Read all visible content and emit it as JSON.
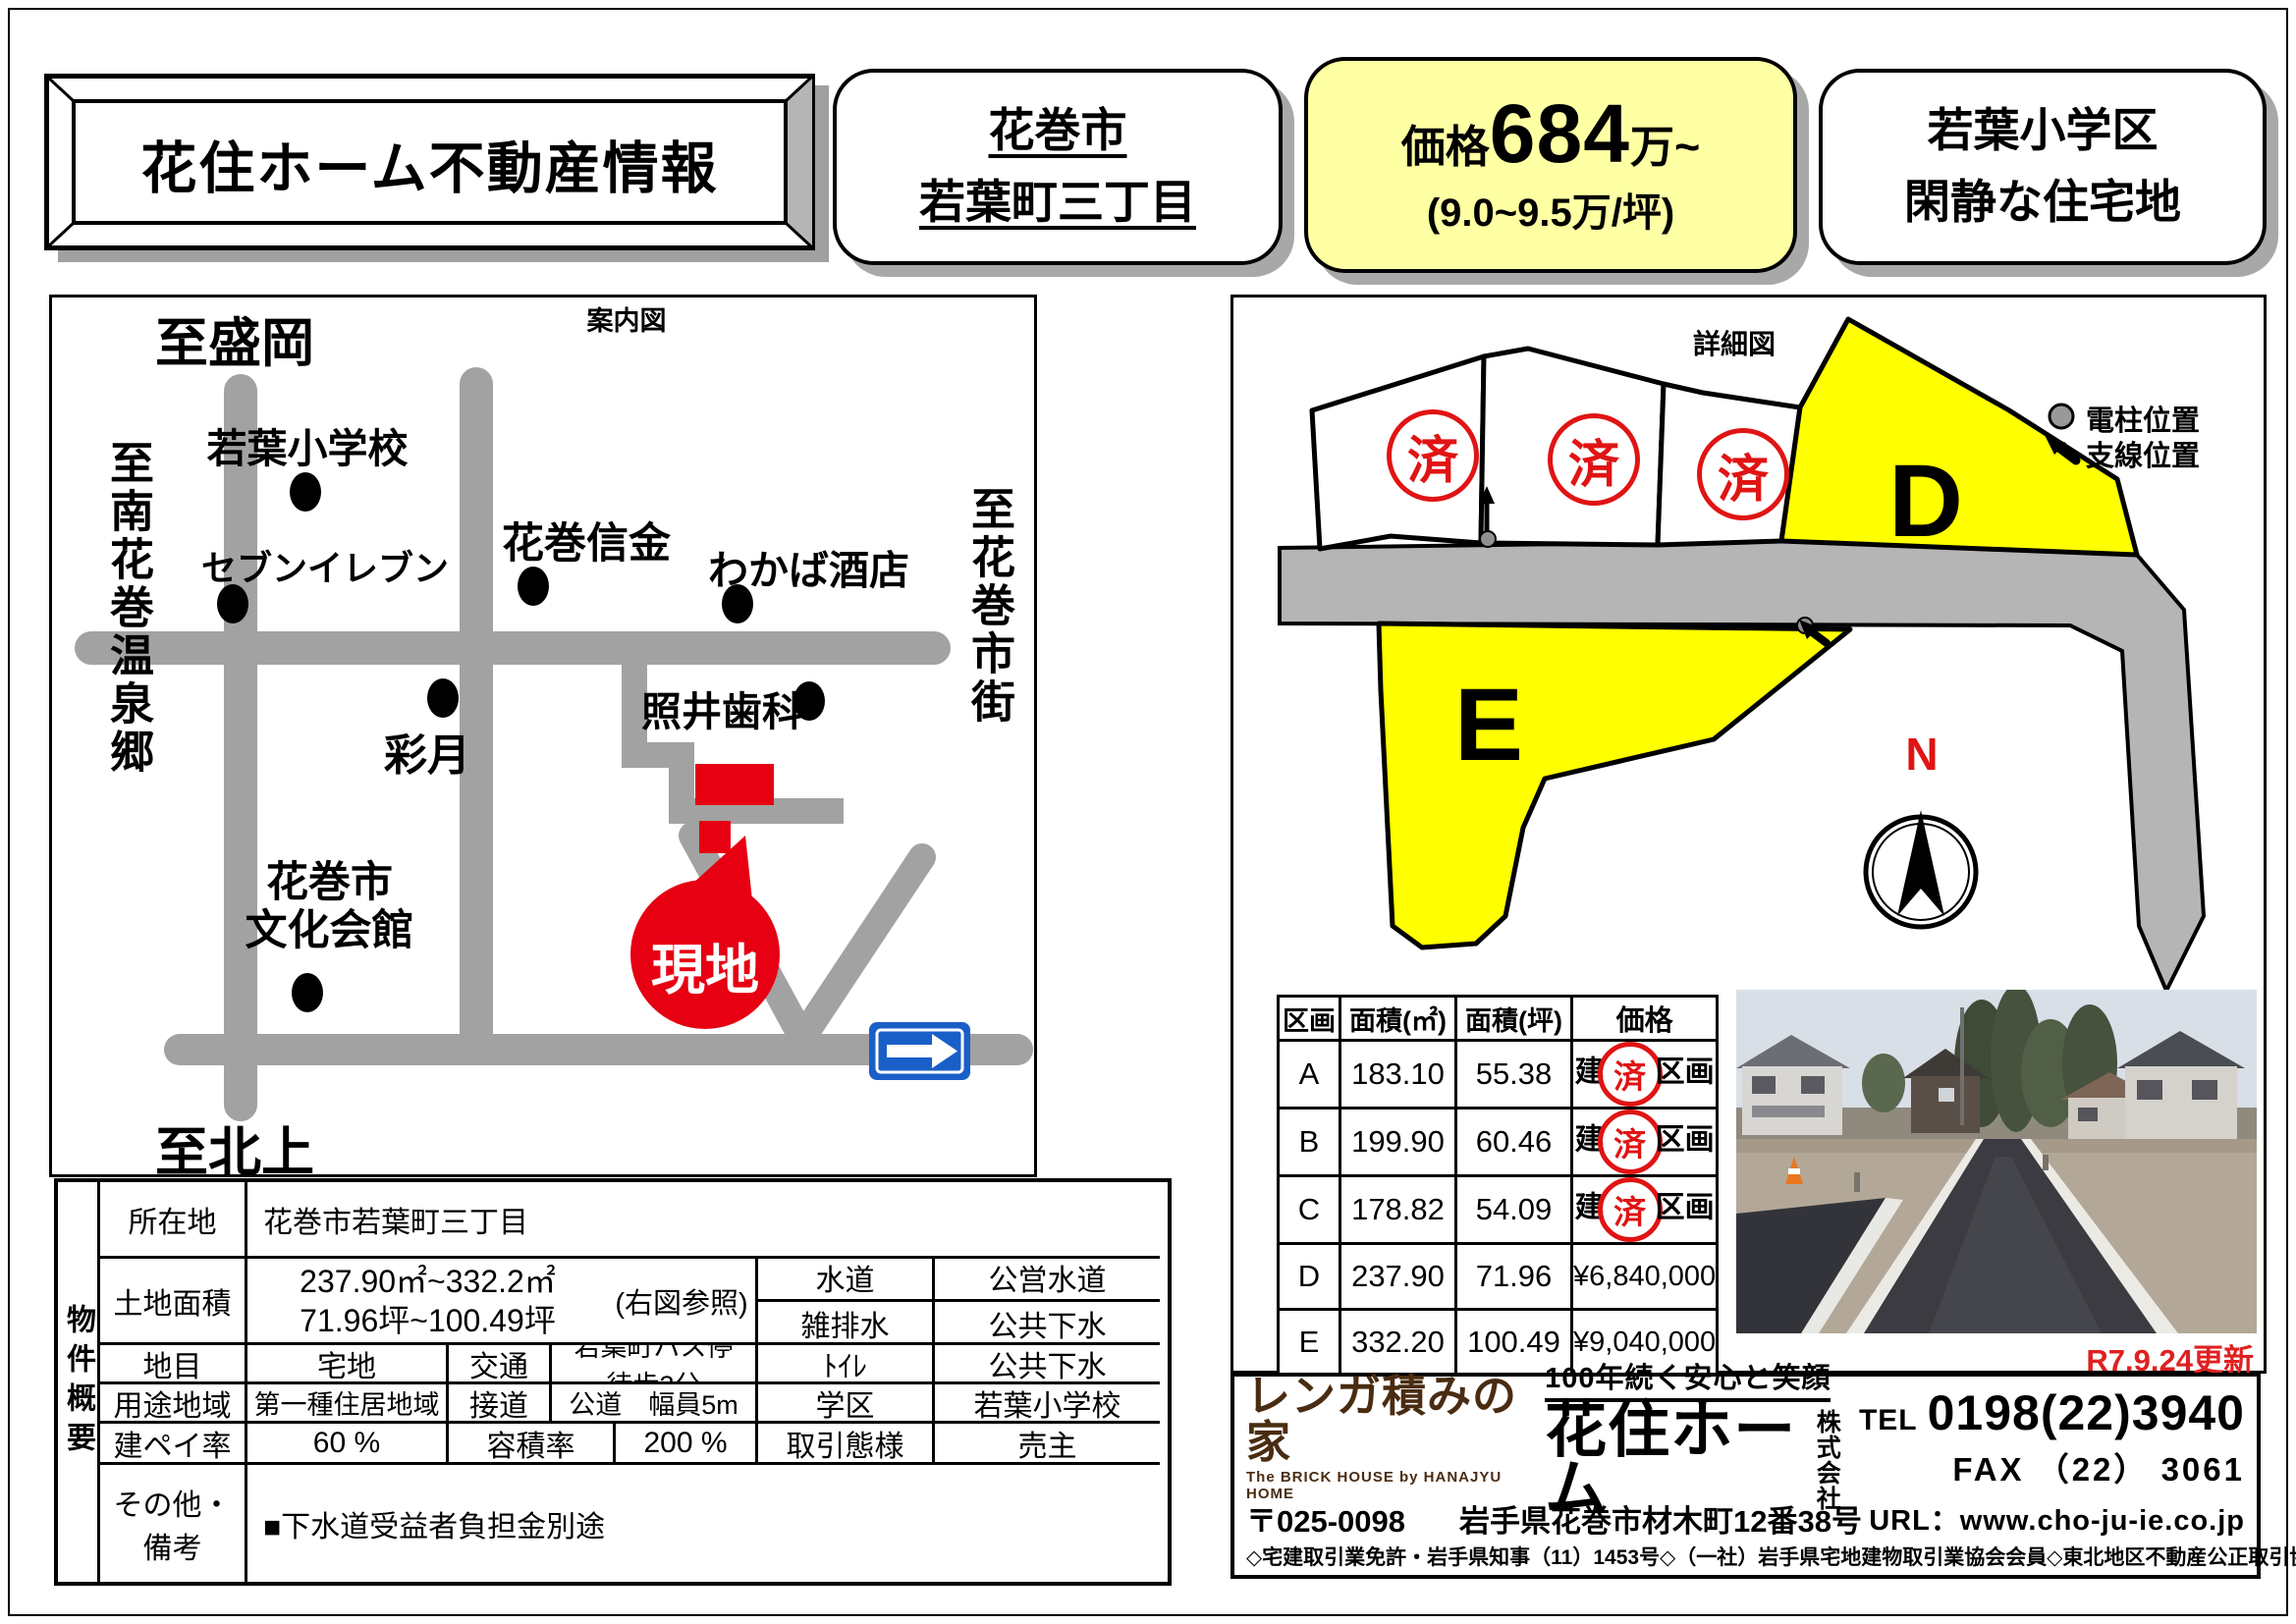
{
  "header": {
    "title": "花住ホーム不動産情報",
    "location_box": {
      "line1": "花巻市",
      "line2": "若葉町三丁目"
    },
    "price_box": {
      "prefix": "価格",
      "value": "684",
      "suffix": "万~",
      "sub": "(9.0~9.5万/坪)"
    },
    "feature_box": {
      "line1": "若葉小学区",
      "line2": "閑静な住宅地"
    }
  },
  "guide_map": {
    "title": "案内図",
    "labels": {
      "to_morioka": "至盛岡",
      "to_kitakami": "至北上",
      "to_minami_hanamaki_onsen": "至南花巻温泉郷",
      "to_hanamaki_shigai": "至花巻市街",
      "wakaba_elementary": "若葉小学校",
      "seven_eleven": "セブンイレブン",
      "hanamaki_shinkin": "花巻信金",
      "wakaba_sakaten": "わかば酒店",
      "terui_dental": "照井歯科",
      "saigetsu": "彩月",
      "bunka_kaikan_line1": "花巻市",
      "bunka_kaikan_line2": "文化会館",
      "site_balloon": "現地"
    }
  },
  "detail_map": {
    "title": "詳細図",
    "legend_pole": "電柱位置",
    "legend_wire": "支線位置",
    "lot_d_label": "D",
    "lot_e_label": "E",
    "sold_stamp": "済",
    "compass_n": "N"
  },
  "price_table": {
    "headers": [
      "区画",
      "面積(㎡)",
      "面積(坪)",
      "価格"
    ],
    "rows": [
      {
        "lot": "A",
        "sqm": "183.10",
        "tsubo": "55.38",
        "price_pre": "建",
        "stamp": "済",
        "price_post": "区画",
        "price": ""
      },
      {
        "lot": "B",
        "sqm": "199.90",
        "tsubo": "60.46",
        "price_pre": "建",
        "stamp": "済",
        "price_post": "区画",
        "price": ""
      },
      {
        "lot": "C",
        "sqm": "178.82",
        "tsubo": "54.09",
        "price_pre": "建",
        "stamp": "済",
        "price_post": "区画",
        "price": ""
      },
      {
        "lot": "D",
        "sqm": "237.90",
        "tsubo": "71.96",
        "price_pre": "",
        "stamp": "",
        "price_post": "",
        "price": "¥6,840,000"
      },
      {
        "lot": "E",
        "sqm": "332.20",
        "tsubo": "100.49",
        "price_pre": "",
        "stamp": "",
        "price_post": "",
        "price": "¥9,040,000"
      }
    ]
  },
  "property_summary": {
    "side_label": "物件概要",
    "location_label": "所在地",
    "location": "花巻市若葉町三丁目",
    "land_area_label": "土地面積",
    "land_area_sqm": "237.90㎡~332.2㎡",
    "land_area_tsubo": "71.96坪~100.49坪",
    "map_ref": "(右図参照)",
    "chimoku_label": "地目",
    "chimoku": "宅地",
    "kotsu_label": "交通",
    "kotsu": "若葉町バス停　徒歩3分",
    "yoto_label": "用途地域",
    "yoto": "第一種住居地域",
    "setsudo_label": "接道",
    "setsudo": "公道　幅員5m",
    "kenpei_label": "建ペイ率",
    "kenpei": "60 %",
    "yoseki_label": "容積率",
    "yoseki": "200 %",
    "suido_label": "水道",
    "suido": "公営水道",
    "zohaisui_label": "雑排水",
    "zohaisui": "公共下水",
    "toilet_label": "ﾄｲﾚ",
    "toilet": "公共下水",
    "gakku_label": "学区",
    "gakku": "若葉小学校",
    "torihiki_label": "取引態様",
    "torihiki": "売主",
    "other_label": "その他・備考",
    "other": "■下水道受益者負担金別途"
  },
  "company": {
    "brand": "レンガ積みの家",
    "brand_sub": "The BRICK HOUSE by HANAJYU HOME",
    "slogan": "100年続く安心と笑顔",
    "name": "花住ホーム",
    "name_suffix1": "株式",
    "name_suffix2": "会社",
    "tel_label": "TEL",
    "tel": "0198(22)3940",
    "fax": "FAX （22） 3061",
    "postal": "〒025-0098",
    "address": "岩手県花巻市材木町12番38号",
    "url": "URL：www.cho-ju-ie.co.jp",
    "license": "◇宅建取引業免許・岩手県知事（11）1453号◇（一社）岩手県宅地建物取引業協会会員◇東北地区不動産公正取引協議会加盟"
  },
  "updated": "R7.9.24更新",
  "colors": {
    "accent_red": "#e01414",
    "lot_yellow": "#ffff00",
    "road_grey": "#a2a2a2",
    "sign_blue": "#1a5fc8",
    "brand_brown": "#4a2c12"
  }
}
